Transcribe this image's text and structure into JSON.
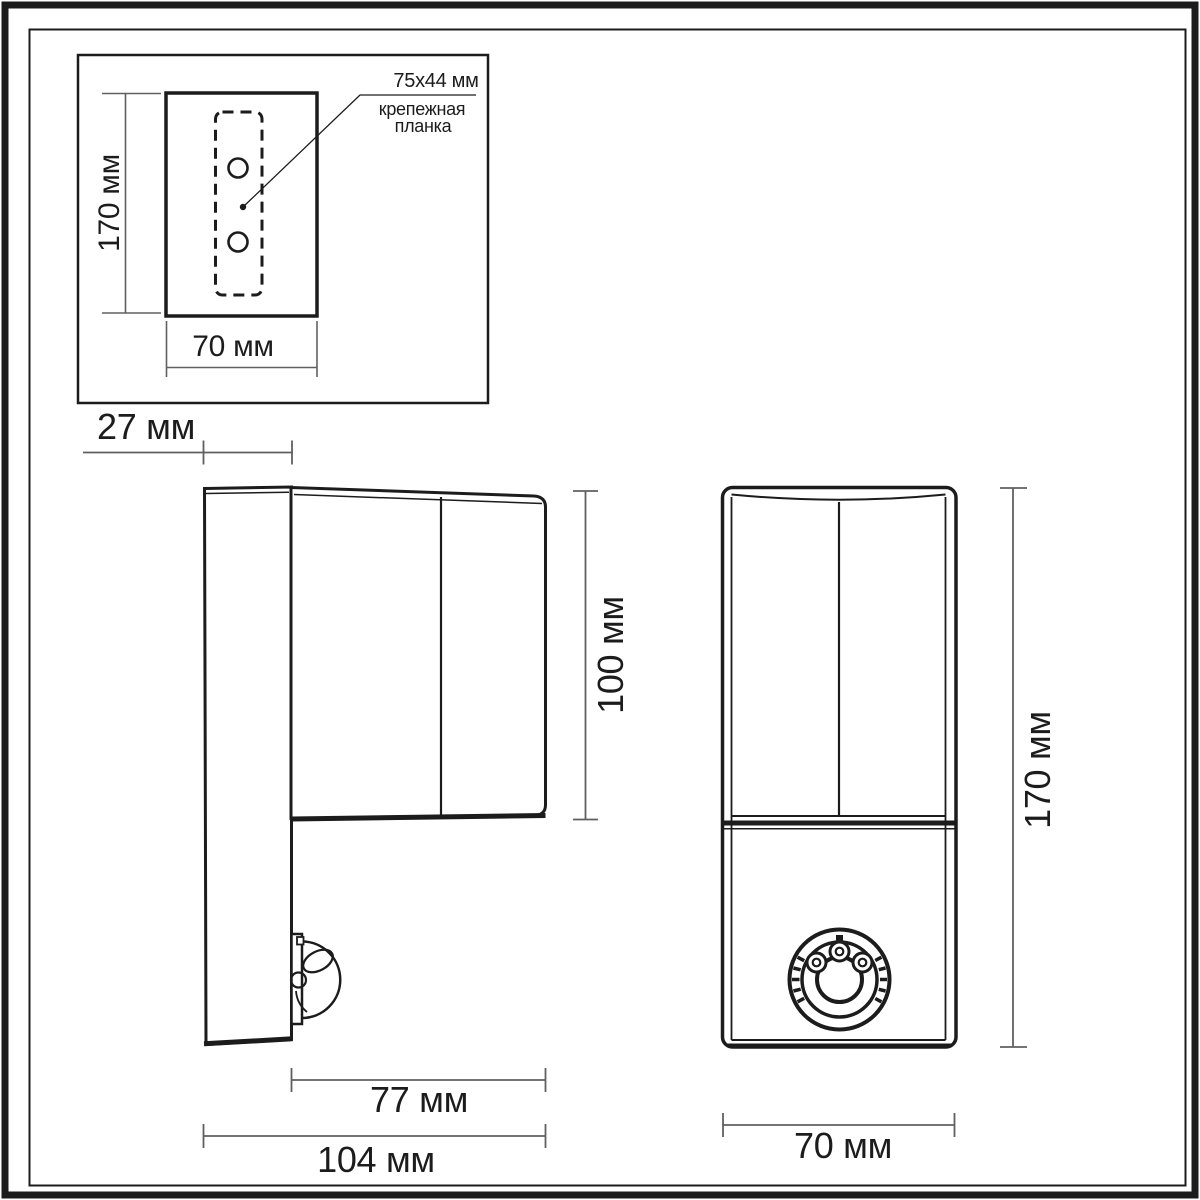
{
  "page": {
    "background": "#ffffff",
    "line_color": "#1c1c1c",
    "dim_line_color": "#606060"
  },
  "inset_view": {
    "annotation_size": "75x44 мм",
    "annotation_label_line1": "крепежная",
    "annotation_label_line2": "планка",
    "dim_height": "170 мм",
    "dim_width": "70 мм"
  },
  "side_view": {
    "dim_plate_depth": "27 мм",
    "dim_body_height": "100 мм",
    "dim_body_depth": "77 мм",
    "dim_total_depth": "104 мм"
  },
  "front_view": {
    "dim_height": "170 мм",
    "dim_width": "70 мм"
  }
}
